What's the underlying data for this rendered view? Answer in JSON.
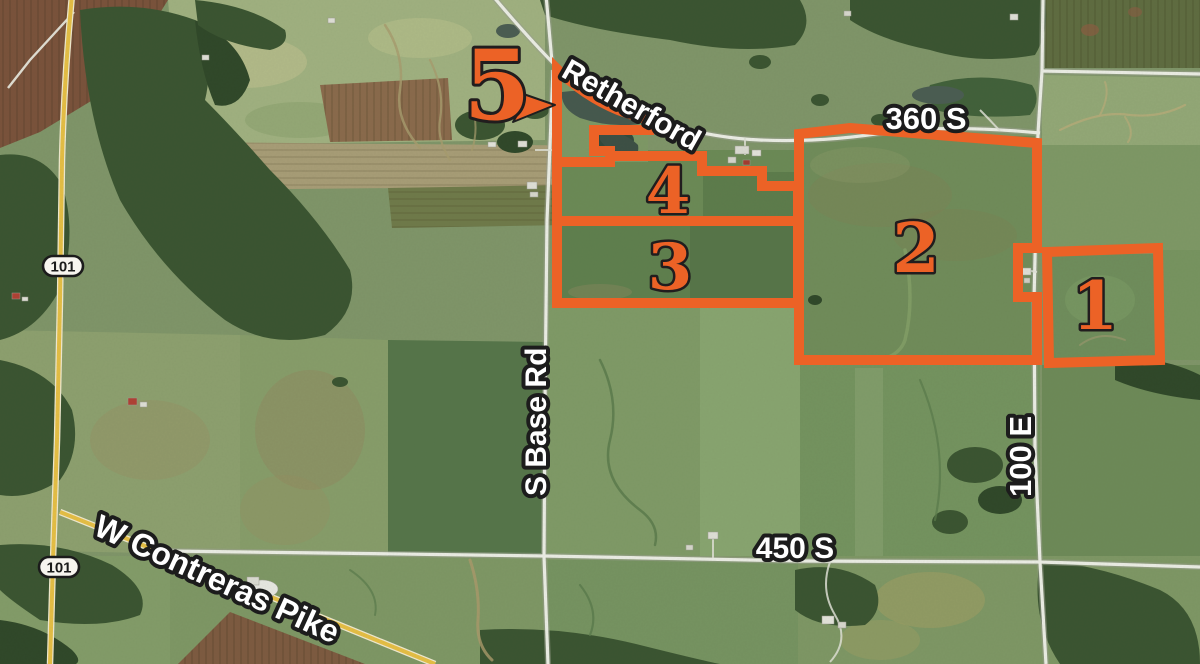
{
  "map": {
    "type": "aerial-parcel-map",
    "road_labels": {
      "retherford": "Retherford",
      "route_360_s": "360 S",
      "s_base_rd": "S Base Rd",
      "route_100_e": "100 E",
      "route_450_s": "450 S",
      "w_contreras_pike": "W Contreras Pike"
    },
    "route_shields": [
      {
        "number": "101"
      },
      {
        "number": "101"
      }
    ],
    "tracts": [
      {
        "number": "1"
      },
      {
        "number": "2"
      },
      {
        "number": "3"
      },
      {
        "number": "4"
      },
      {
        "number": "5"
      }
    ],
    "colors": {
      "tract_outline": "#ec6226",
      "label_fill": "#ffffff",
      "label_outline": "#1c1c1c",
      "highway_yellow": "#e6bf45"
    }
  }
}
